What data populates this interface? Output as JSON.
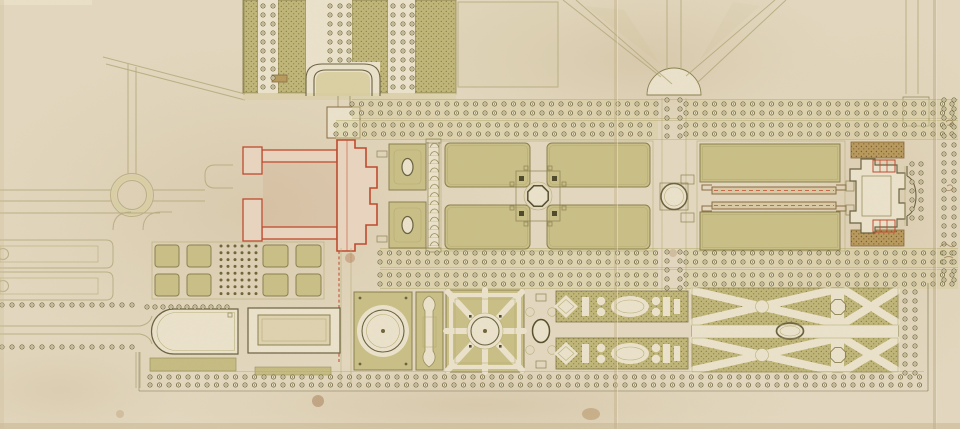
{
  "document": {
    "title": "Plan of a formal garden estate — ink, olive wash and red chalk on aged paper",
    "kind": "scanned archival drawing, no printed text visible",
    "aria_label": "Hand-drawn seventeenth-century style plan of a chateau and formal gardens: red-outlined chateau with courtyard at left, orchard quincunx and horseshoe court above, tree-lined double allees, a quartered green parterre with central octagonal basin, a circular basin, a twin-channel canal garden leading to an eastern pavilion with exedra, and a southern band with long basin, rectangular basin, circle and saltire parterres, oval basins, broderie strips and diamond-lattice beds, all on browned paper with vertical fold creases"
  },
  "palette": {
    "paper": "#e3d8bf",
    "paper_light": "#ebe2cb",
    "paper_dark": "#d7caa9",
    "olive": "#c9bf87",
    "olive_light": "#d7cd9d",
    "olive_deep": "#b2a86e",
    "stipple_base": "#c0b679",
    "ink": "#8a8050",
    "ink_strong": "#6a6240",
    "brown": "#8a6b42",
    "tree_ink": "#6e6539",
    "stip": "#847b46",
    "red": "#bf4a2e",
    "red_wash": "#e9d5bf",
    "brown_block": "#b89a5d",
    "brown_dot": "#7c5c30",
    "stain": "#9c6b3f",
    "crease": "#b9a87f"
  },
  "regions": [
    {
      "id": "west-approach-paths",
      "label": "faint western approach paths and rond-point"
    },
    {
      "id": "orchard-quincunx",
      "label": "stippled orchard with rows of trees"
    },
    {
      "id": "horseshoe-court",
      "label": "horseshoe-shaped court"
    },
    {
      "id": "forecourt-plaza",
      "label": "square forecourt plaza"
    },
    {
      "id": "chateau-plan",
      "label": "chateau outlined in red chalk"
    },
    {
      "id": "patte-d-oie",
      "label": "half-round with three radiating avenues"
    },
    {
      "id": "tree-allees",
      "label": "double rows of clipped trees along the main axis"
    },
    {
      "id": "terrace-pool-gardens",
      "label": "two terrace gardens with oval pools"
    },
    {
      "id": "trellis-arcade",
      "label": "arched trellis walk"
    },
    {
      "id": "grand-parterre",
      "label": "four green panels around octagonal basin"
    },
    {
      "id": "circular-basin",
      "label": "round basin on the cross axis"
    },
    {
      "id": "canal-garden",
      "label": "twin-channel canal garden"
    },
    {
      "id": "east-pavilion",
      "label": "eastern pavilion with courtyard and exedra"
    },
    {
      "id": "south-parterre-grids",
      "label": "square bed grids and quincunx south of the chateau"
    },
    {
      "id": "long-basin",
      "label": "long round-ended basin"
    },
    {
      "id": "rectangular-basin",
      "label": "rectangular basin"
    },
    {
      "id": "circle-parterre",
      "label": "square parterre with circular ring"
    },
    {
      "id": "goblet-parterre",
      "label": "narrow parterre with goblet bed"
    },
    {
      "id": "saltire-parterre",
      "label": "parterre with diagonal cross and ring"
    },
    {
      "id": "oval-basin-node",
      "label": "oval basin node with four small pools"
    },
    {
      "id": "broderie-strips",
      "label": "stippled strips with oval and diamond cut-outs"
    },
    {
      "id": "diamond-parterres",
      "label": "diamond-lattice parterres with oval pool"
    },
    {
      "id": "boundary-allees",
      "label": "boundary tree rows and enclosure lines"
    },
    {
      "id": "paper-texture",
      "label": "aged paper, folds and stains"
    }
  ]
}
